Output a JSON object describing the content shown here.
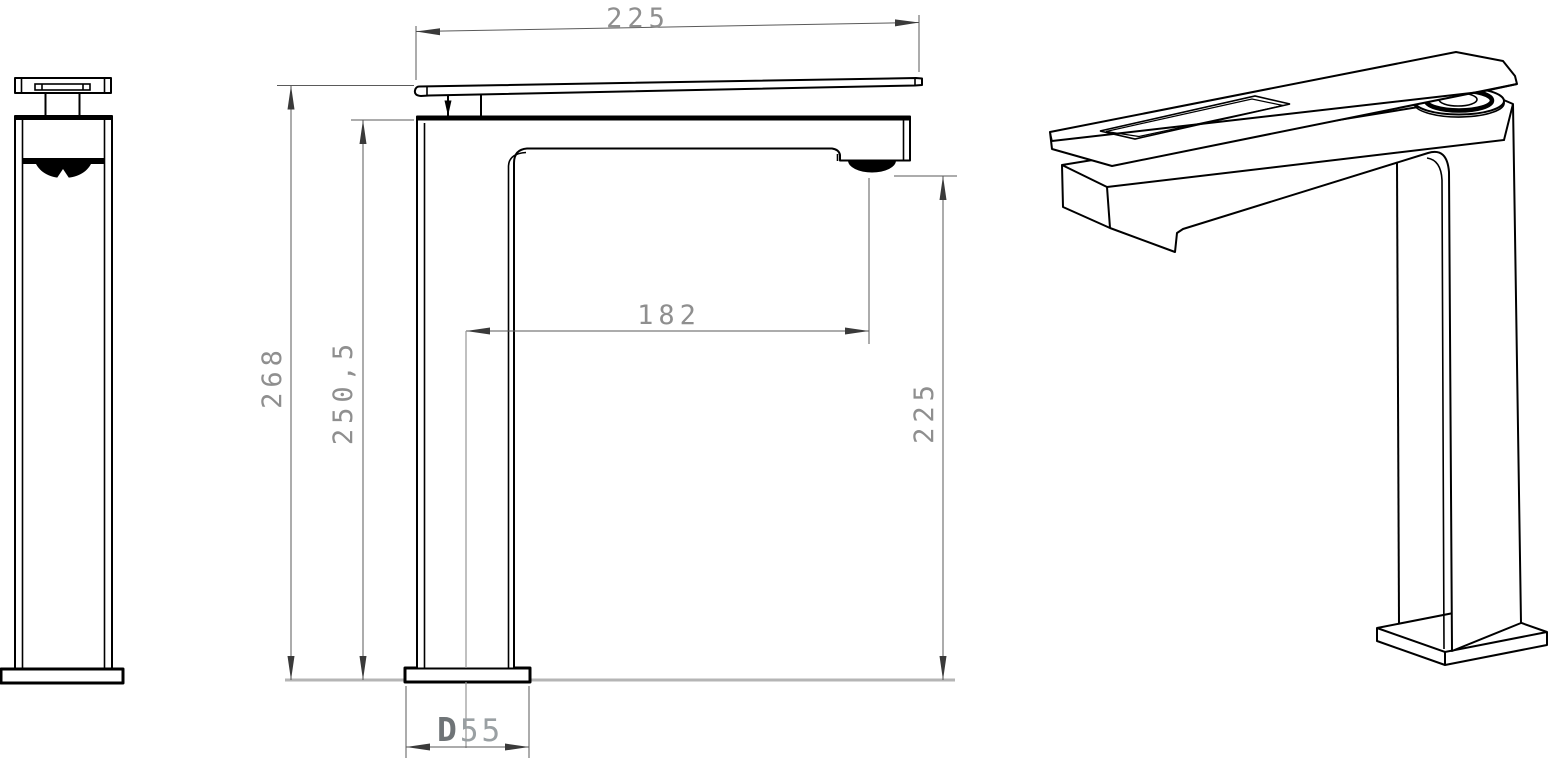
{
  "drawing": {
    "kind": "technical-drawing",
    "subject": "single-lever tall basin mixer tap, three orthographic/isometric views",
    "views": {
      "side": "side-view",
      "front": "front-view",
      "iso": "isometric-view"
    },
    "dimensions": {
      "top_width": "225",
      "overall_height": "268",
      "height_to_spout_top": "250,5",
      "spout_reach": "182",
      "spout_outlet_height": "225",
      "base_width": {
        "prefix": "D",
        "value": "55"
      }
    },
    "colors": {
      "line": "#000000",
      "dimension_text": "#8f8f8f",
      "dimension_line": "#5a5a5a",
      "ground_line": "#b5b5b5"
    }
  }
}
